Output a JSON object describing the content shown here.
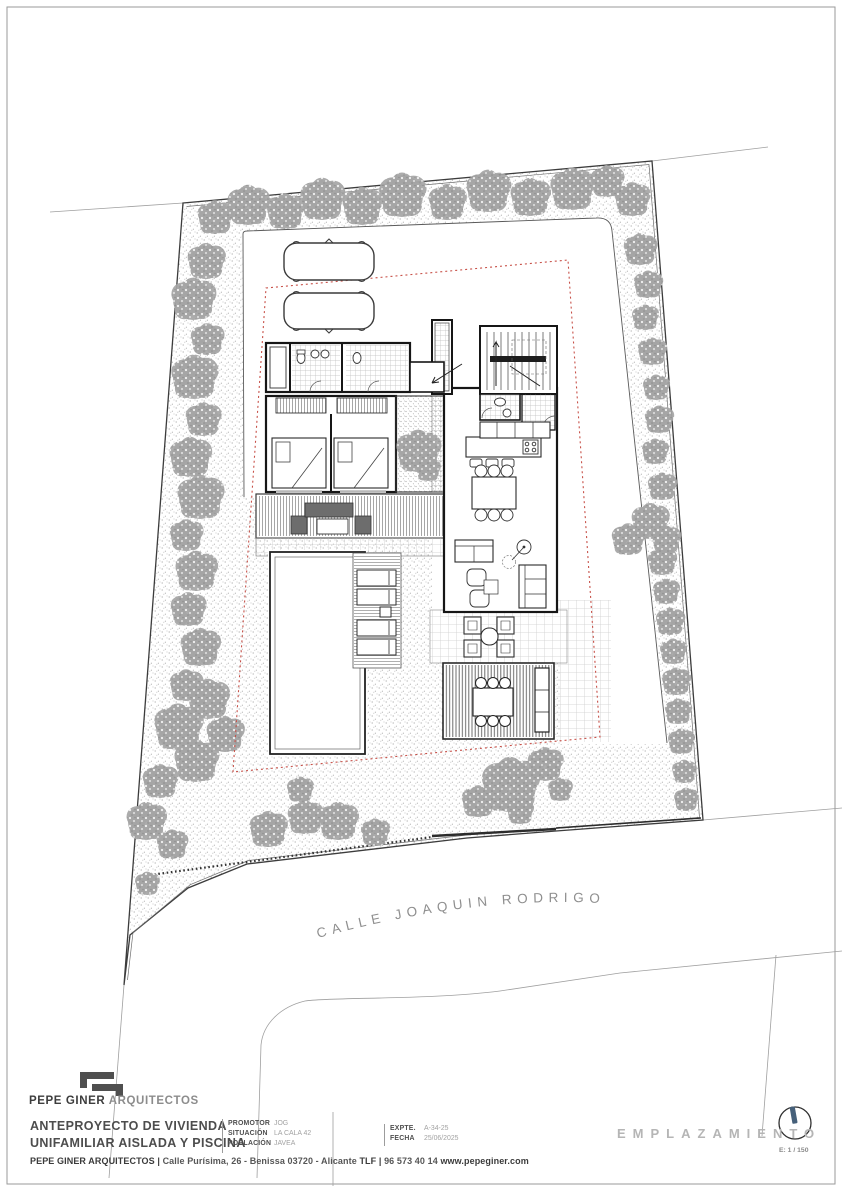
{
  "plan": {
    "street_label": "CALLE JOAQUIN RODRIGO",
    "colors": {
      "setback_line": "#c75048",
      "boundary": "#3c3c3c",
      "tree": "#a3a3a3",
      "wall": "#161616"
    }
  },
  "title_block": {
    "brand_bold": "PEPE GINER",
    "brand_light": "ARQUITECTOS",
    "project_line1": "ANTEPROYECTO DE VIVIENDA",
    "project_line2": "UNIFAMILIAR AISLADA Y PISCINA",
    "fields": [
      {
        "label": "PROMOTOR",
        "value": "JOG"
      },
      {
        "label": "SITUACIÓN",
        "value": "LA CALA 42"
      },
      {
        "label": "POBLACIÓN",
        "value": "JAVEA"
      }
    ],
    "fields2": [
      {
        "label": "EXPTE.",
        "value": "A-34-25"
      },
      {
        "label": "FECHA",
        "value": "25/06/2025"
      }
    ],
    "footer_name": "PEPE GINER ARQUITECTOS",
    "footer_sep": "|",
    "footer_address": "Calle Purísima, 26 - Benissa 03720 - Alicante",
    "footer_tlf": "TLF |",
    "footer_phone": "96 573 40 14",
    "footer_web": "www.pepeginer.com",
    "sheet_name": "E M P L A Z A M I E N T O",
    "sheet_name_plain": "EMPLAZAMIENTO",
    "scale_label": "E: 1 / 150",
    "north_icon": "compass-north-icon"
  }
}
